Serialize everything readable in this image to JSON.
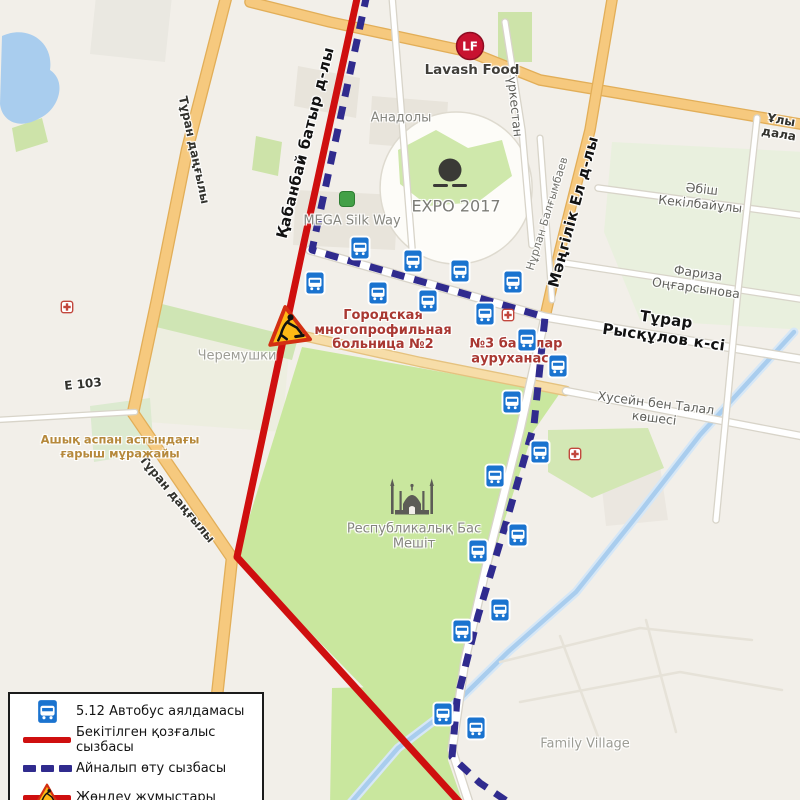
{
  "map": {
    "background": "#f2efe9",
    "areas": [
      {
        "name": "cheremushki-block",
        "d": "M150,306 L290,340 L282,432 L148,422 Z",
        "fill": "#ebeedd",
        "op": 0.8
      },
      {
        "name": "top-left-block",
        "d": "M96,-4 L172,-4 L165,62 L90,54 Z",
        "fill": "#eae8e1"
      },
      {
        "name": "building",
        "d": "M296,190 L398,195 L395,250 L293,245 Z",
        "fill": "#e8e4db"
      },
      {
        "name": "building",
        "d": "M372,96 L448,102 L445,150 L369,144 Z",
        "fill": "#e8e4db"
      },
      {
        "name": "building",
        "d": "M298,66 L360,78 L356,118 L294,106 Z",
        "fill": "#e8e4db"
      },
      {
        "name": "building",
        "d": "M600,470 L660,466 L668,520 L606,526 Z",
        "fill": "#e8e4db",
        "op": 0.7
      },
      {
        "name": "expo-grounds",
        "d": "M456,112 a76,76 0 1 0 0.2,0 Z",
        "fill": "#fdfcf8",
        "stroke": "#dedacf",
        "sw": 1.5
      },
      {
        "name": "expo-green",
        "d": "M398,150 L436,130 L468,148 L502,140 L512,176 L478,202 L428,206 L400,184 Z",
        "fill": "#cfe8ab"
      },
      {
        "name": "east-green",
        "d": "M612,142 L806,152 L806,330 L640,320 L604,232 Z",
        "fill": "#e7f0dc",
        "op": 0.85
      },
      {
        "name": "green-patch",
        "d": "M12,128 L42,118 L48,142 L16,152 Z",
        "fill": "#cde3a9"
      },
      {
        "name": "green-patch",
        "d": "M256,136 L282,142 L278,176 L252,170 Z",
        "fill": "#cde3a9"
      },
      {
        "name": "green-patch",
        "d": "M498,12 L532,12 L532,62 L498,62 Z",
        "fill": "#cde3a9"
      },
      {
        "name": "green-patch",
        "d": "M548,430 L648,428 L664,468 L592,498 L548,472 Z",
        "fill": "#d3e7b4"
      },
      {
        "name": "museum-green",
        "d": "M90,406 L150,398 L154,452 L94,462 Z",
        "fill": "#dcead0"
      },
      {
        "name": "cheremushki-green",
        "d": "M158,303 L298,338 L292,360 L152,326 Z",
        "fill": "#cfe5b4"
      },
      {
        "name": "main-park",
        "d": "M302,347 L560,393 L533,432 L503,525 L476,617 L455,700 L448,760 L408,733 L237,557 Z",
        "fill": "#c9e79e"
      },
      {
        "name": "southwest-green",
        "d": "M332,688 L422,686 L464,806 L330,806 Z",
        "fill": "#c9e79e"
      },
      {
        "name": "lake",
        "d": "M2,36 C28,24 54,42 50,70 C68,82 58,110 40,118 C20,130 2,122 0,104 Z",
        "fill": "#a9cdee"
      }
    ],
    "water_paths": [
      {
        "d": "M794,332 L700,435 L640,512 L576,592 L508,652 L452,707 L398,748 L348,806",
        "color": "#a9cdee",
        "w": 4.5,
        "halo": "#d6e7f6",
        "hw": 9
      }
    ],
    "roads": [
      {
        "name": "turan-avenue",
        "d": "M227,-6 L187,150 L157,300 L133,413 L232,558 L205,806",
        "w": 10,
        "fill": "#f6c97e",
        "casing": "#e2ae58"
      },
      {
        "name": "uly-dala-avenue",
        "d": "M250,2 L330,22 L470,52 L540,80 L806,125",
        "w": 9,
        "fill": "#f6c97e",
        "casing": "#e2ae58"
      },
      {
        "name": "mangilik-el-avenue",
        "d": "M613,-6 L590,130 L560,250 L545,317",
        "w": 9,
        "fill": "#f6c97e",
        "casing": "#e2ae58"
      },
      {
        "name": "hussein-west",
        "d": "M290,333 L420,362 L566,391",
        "w": 8,
        "fill": "#f7dda8",
        "casing": "#e5c27f"
      },
      {
        "name": "mangilik-south",
        "d": "M545,317 L520,430 L490,550 L465,660 L452,750 L470,806",
        "w": 7,
        "fill": "#ffffff",
        "casing": "#d8d4c9"
      },
      {
        "name": "ryskulov-street",
        "d": "M310,250 L545,317 L806,360",
        "w": 7,
        "fill": "#ffffff",
        "casing": "#d8d4c9"
      },
      {
        "name": "hussein-east",
        "d": "M566,391 L806,437",
        "w": 6,
        "fill": "#ffffff",
        "casing": "#d8d4c9"
      },
      {
        "name": "abish-street",
        "d": "M598,188 L806,216",
        "w": 5,
        "fill": "#ffffff",
        "casing": "#d8d4c9"
      },
      {
        "name": "fariza-street",
        "d": "M558,262 L806,300",
        "w": 5,
        "fill": "#ffffff",
        "casing": "#d8d4c9"
      },
      {
        "name": "turkestan-street",
        "d": "M505,22 L522,130 L532,245",
        "w": 5,
        "fill": "#ffffff",
        "casing": "#d8d4c9"
      },
      {
        "name": "nurlan-street",
        "d": "M540,138 L552,300",
        "w": 4.5,
        "fill": "#ffffff",
        "casing": "#d8d4c9"
      },
      {
        "name": "east-street",
        "d": "M757,118 L737,300 L716,520",
        "w": 5,
        "fill": "#ffffff",
        "casing": "#d8d4c9"
      },
      {
        "name": "e103-road",
        "d": "M-4,420 L135,412",
        "w": 4,
        "fill": "#ffffff",
        "casing": "#d8d4c9"
      },
      {
        "name": "anadoly-street",
        "d": "M392,-4 L402,120 L412,248",
        "w": 5,
        "fill": "#ffffff",
        "casing": "#d8d4c9"
      },
      {
        "name": "village-road",
        "d": "M500,662 L640,628 L752,640",
        "w": 2.5,
        "fill": "#e6e2d8"
      },
      {
        "name": "village-road",
        "d": "M520,702 L680,672 L782,690",
        "w": 2.5,
        "fill": "#e6e2d8"
      },
      {
        "name": "village-road",
        "d": "M560,636 L600,742",
        "w": 2.5,
        "fill": "#e6e2d8"
      },
      {
        "name": "village-road",
        "d": "M646,620 L676,732",
        "w": 2.5,
        "fill": "#e6e2d8"
      }
    ],
    "routes": {
      "approved": {
        "d": "M358,-6 L303,247 L237,557 L463,806",
        "color": "#cf0f0f",
        "width": 7
      },
      "detour": {
        "d": "M367,-6 L312,250 L545,317 L534,425 L506,523 L478,616 L457,700 L452,757 L480,783 L514,806",
        "color": "#302b8e",
        "width": 7,
        "dash": "13 10"
      }
    },
    "bus_stops": [
      [
        315,
        285
      ],
      [
        360,
        250
      ],
      [
        378,
        295
      ],
      [
        413,
        263
      ],
      [
        428,
        303
      ],
      [
        460,
        273
      ],
      [
        485,
        316
      ],
      [
        513,
        284
      ],
      [
        527,
        342
      ],
      [
        558,
        368
      ],
      [
        512,
        404
      ],
      [
        540,
        454
      ],
      [
        495,
        478
      ],
      [
        518,
        537
      ],
      [
        478,
        553
      ],
      [
        500,
        612
      ],
      [
        462,
        633
      ],
      [
        443,
        716
      ],
      [
        476,
        730
      ]
    ],
    "roadworks_sign": {
      "x": 288,
      "y": 327,
      "size": 46,
      "rot": -8
    },
    "pois": [
      {
        "type": "lf-logo",
        "x": 470,
        "y": 48,
        "label": "LF"
      },
      {
        "type": "expo-sphere",
        "x": 450,
        "y": 176
      },
      {
        "type": "mega-icon",
        "x": 347,
        "y": 201
      },
      {
        "type": "mosque-icon",
        "x": 412,
        "y": 497
      },
      {
        "type": "medical-icon",
        "x": 67,
        "y": 308
      },
      {
        "type": "medical-icon",
        "x": 508,
        "y": 316
      },
      {
        "type": "medical-icon",
        "x": 575,
        "y": 455
      }
    ],
    "labels": [
      {
        "text": "Қабанбай батыр д-лы",
        "x": 306,
        "y": 143,
        "rot": -76,
        "cls": "street-bold"
      },
      {
        "text": "Мәңгілік Ел д-лы",
        "x": 574,
        "y": 212,
        "rot": -75,
        "cls": "street-bold"
      },
      {
        "text": "Тұрар Рысқұлов к-сі",
        "x": 665,
        "y": 329,
        "rot": 8,
        "cls": "street-bold"
      },
      {
        "text": "Хусейн бен Талал көшесі",
        "x": 655,
        "y": 411,
        "rot": 7,
        "cls": "street-gray"
      },
      {
        "text": "Әбіш Кекілбайұлы",
        "x": 701,
        "y": 197,
        "rot": 6,
        "cls": "street-gray"
      },
      {
        "text": "Фариза Оңғарсынова",
        "x": 697,
        "y": 281,
        "rot": 8,
        "cls": "street-gray"
      },
      {
        "text": "Нұрлан Балғымбаев",
        "x": 548,
        "y": 214,
        "rot": -73,
        "cls": "street-gray-sm"
      },
      {
        "text": "Түркестан",
        "x": 514,
        "y": 103,
        "rot": 84,
        "cls": "street-gray"
      },
      {
        "text": "Тұран даңғылы",
        "x": 194,
        "y": 150,
        "rot": 78,
        "cls": "street-dark-sm"
      },
      {
        "text": "Тұран даңғылы",
        "x": 177,
        "y": 499,
        "rot": 50,
        "cls": "street-dark-sm"
      },
      {
        "text": "Ұлы дала",
        "x": 780,
        "y": 127,
        "rot": 10,
        "cls": "street-dark-sm"
      },
      {
        "text": "Анадолы",
        "x": 401,
        "y": 118,
        "rot": 0,
        "cls": "area-gray"
      },
      {
        "text": "EXPO 2017",
        "x": 456,
        "y": 207,
        "rot": 0,
        "cls": "area-gray-lg"
      },
      {
        "text": "Черемушки",
        "x": 237,
        "y": 356,
        "rot": 0,
        "cls": "area-pale"
      },
      {
        "text": "Е 103",
        "x": 83,
        "y": 384,
        "rot": -6,
        "cls": "street-dark-sm"
      },
      {
        "text": "Family Village",
        "x": 585,
        "y": 744,
        "rot": 0,
        "cls": "area-pale"
      },
      {
        "text": "Городская\nмногопрофильная\nбольница №2",
        "x": 383,
        "y": 331,
        "rot": 0,
        "cls": "poi-red",
        "layer": "below"
      },
      {
        "text": "№3 балалар\nауруханасы",
        "x": 516,
        "y": 352,
        "rot": 0,
        "cls": "poi-red",
        "layer": "below"
      },
      {
        "text": "Республикалық Бас\nМешіт",
        "x": 414,
        "y": 537,
        "rot": 0,
        "cls": "area-gray"
      },
      {
        "text": "Ашық аспан астындағы\nғарыш мұражайы",
        "x": 120,
        "y": 447,
        "rot": 0,
        "cls": "poi-orange"
      },
      {
        "text": "Lavash Food",
        "x": 472,
        "y": 71,
        "rot": 0,
        "cls": "poi-dark"
      },
      {
        "text": "MEGA Silk Way",
        "x": 352,
        "y": 221,
        "rot": 0,
        "cls": "area-gray"
      }
    ]
  },
  "legend": {
    "items": [
      {
        "key": "bus-stop",
        "label": "5.12 Автобус аялдамасы"
      },
      {
        "key": "approved-route",
        "label": "Бекітілген қозғалыс сызбасы"
      },
      {
        "key": "detour-route",
        "label": "Айналып өту сызбасы"
      },
      {
        "key": "roadworks",
        "label": "Жөндеу жұмыстары"
      }
    ]
  }
}
